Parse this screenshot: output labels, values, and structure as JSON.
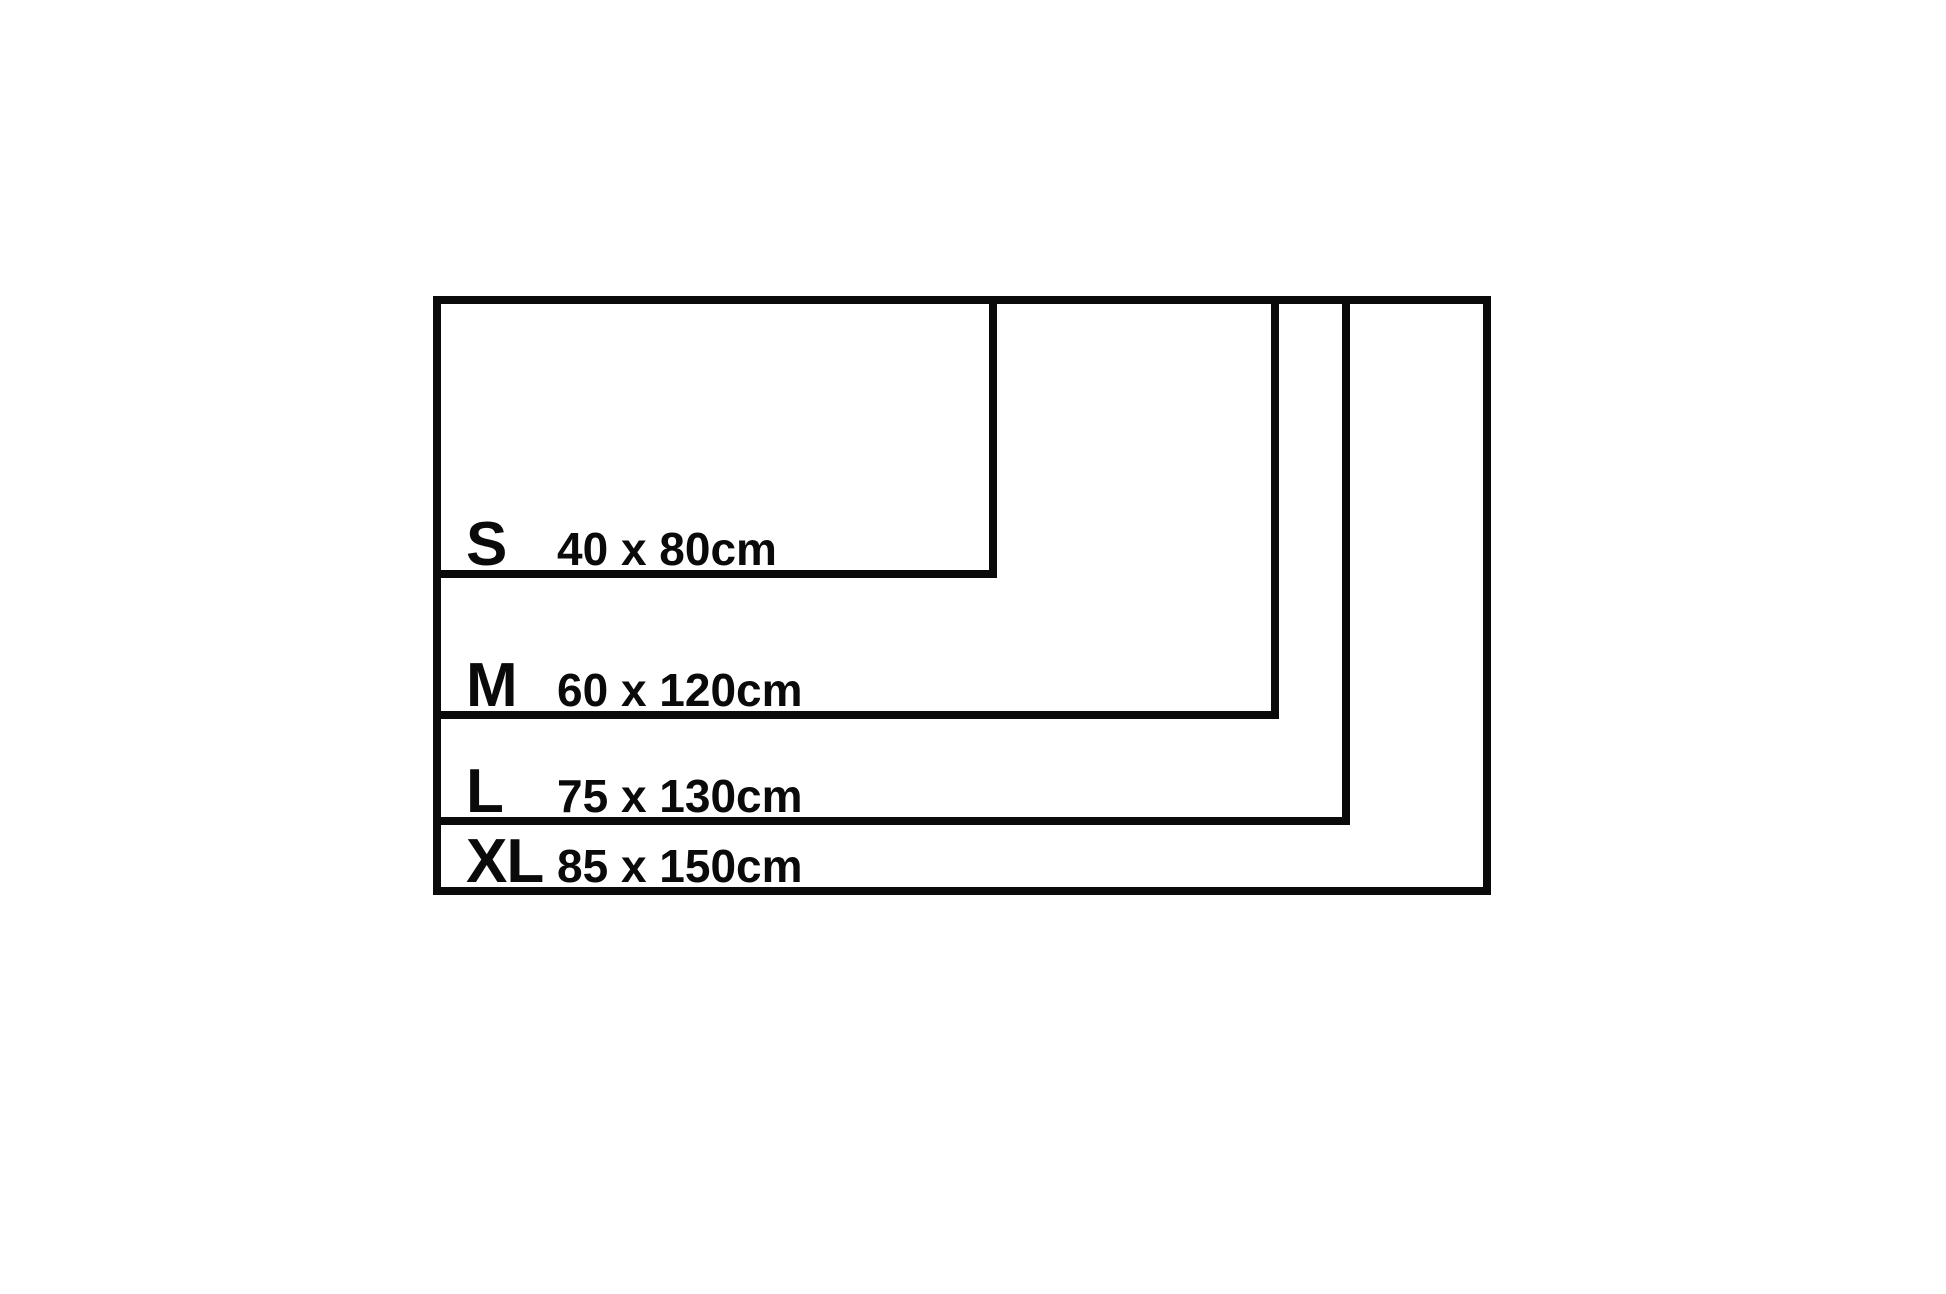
{
  "canvas": {
    "background_color": "#ffffff",
    "line_color": "#0a0a0a"
  },
  "diagram": {
    "type": "nested-rectangle-size-chart",
    "unit": "cm",
    "origin_px": {
      "x": 433,
      "y": 296
    },
    "scale_px_per_cm": 7.05,
    "border_px": 8,
    "sizes": [
      {
        "size": "S",
        "dims": "40 x 80cm",
        "height_cm": 40,
        "width_cm": 80
      },
      {
        "size": "M",
        "dims": "60 x 120cm",
        "height_cm": 60,
        "width_cm": 120
      },
      {
        "size": "L",
        "dims": "75 x 130cm",
        "height_cm": 75,
        "width_cm": 130
      },
      {
        "size": "XL",
        "dims": "85 x 150cm",
        "height_cm": 85,
        "width_cm": 150
      }
    ]
  }
}
